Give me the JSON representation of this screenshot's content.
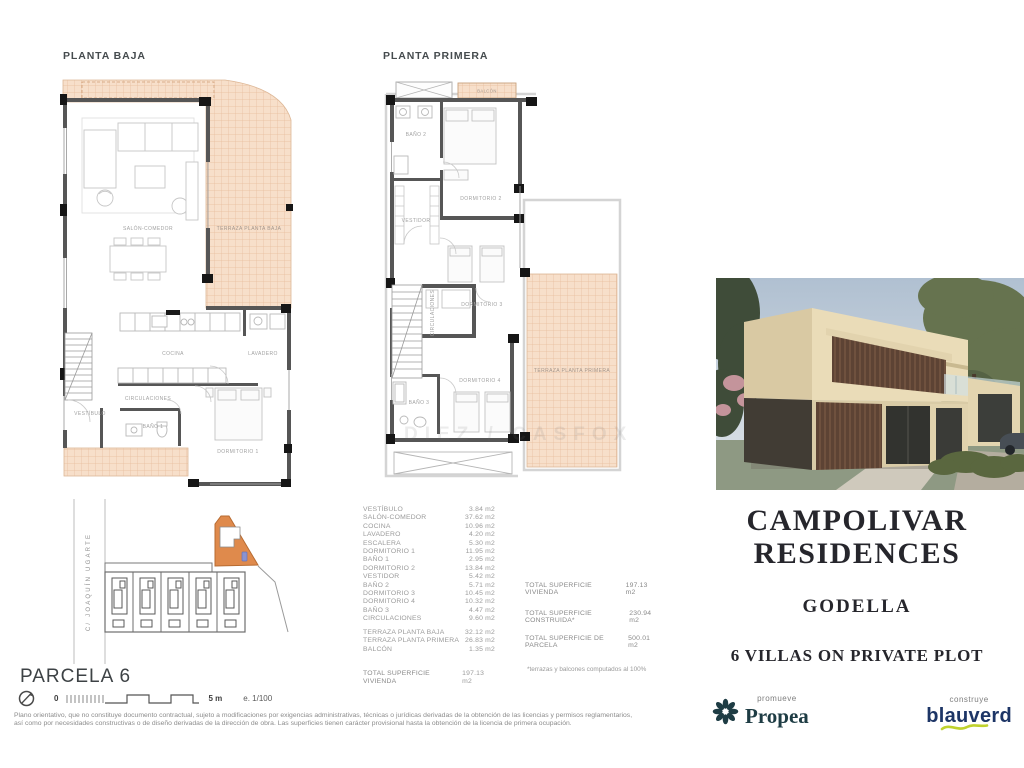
{
  "plans": {
    "planta_baja": {
      "title": "PLANTA BAJA",
      "rooms": {
        "salon": "SALÓN-COMEDOR",
        "terraza": "TERRAZA PLANTA BAJA",
        "cocina": "COCINA",
        "lavadero": "LAVADERO",
        "circulaciones": "CIRCULACIONES",
        "vestibulo": "VESTÍBULO",
        "bano1": "BAÑO 1",
        "dormitorio1": "DORMITORIO 1"
      }
    },
    "planta_primera": {
      "title": "PLANTA PRIMERA",
      "rooms": {
        "balcon": "BALCÓN",
        "bano2": "BAÑO 2",
        "dormitorio2": "DORMITORIO 2",
        "vestidor": "VESTIDOR",
        "circulaciones": "CIRCULACIONES",
        "dormitorio3": "DORMITORIO 3",
        "dormitorio4": "DORMITORIO 4",
        "bano3": "BAÑO 3",
        "terraza": "TERRAZA PLANTA PRIMERA"
      }
    }
  },
  "site_plan": {
    "street": "C/ JOAQUÍN UGARTE",
    "title": "PARCELA 6",
    "scale_zero": "0",
    "scale_label": "5 m",
    "scale_ratio": "e. 1/100"
  },
  "area_table": {
    "rows": [
      {
        "label": "VESTÍBULO",
        "value": "3.84 m2"
      },
      {
        "label": "SALÓN-COMEDOR",
        "value": "37.62 m2"
      },
      {
        "label": "COCINA",
        "value": "10.96 m2"
      },
      {
        "label": "LAVADERO",
        "value": "4.20 m2"
      },
      {
        "label": "ESCALERA",
        "value": "5.30 m2"
      },
      {
        "label": "DORMITORIO 1",
        "value": "11.95 m2"
      },
      {
        "label": "BAÑO 1",
        "value": "2.95 m2"
      },
      {
        "label": "DORMITORIO 2",
        "value": "13.84 m2"
      },
      {
        "label": "VESTIDOR",
        "value": "5.42 m2"
      },
      {
        "label": "BAÑO 2",
        "value": "5.71 m2"
      },
      {
        "label": "DORMITORIO 3",
        "value": "10.45 m2"
      },
      {
        "label": "DORMITORIO 4",
        "value": "10.32 m2"
      },
      {
        "label": "BAÑO 3",
        "value": "4.47 m2"
      },
      {
        "label": "CIRCULACIONES",
        "value": "9.60 m2"
      }
    ],
    "terrace_rows": [
      {
        "label": "TERRAZA PLANTA BAJA",
        "value": "32.12 m2"
      },
      {
        "label": "TERRAZA PLANTA PRIMERA",
        "value": "26.83 m2"
      },
      {
        "label": "BALCÓN",
        "value": "1.35 m2"
      }
    ],
    "total_row": {
      "label": "TOTAL SUPERFICIE VIVIENDA",
      "value": "197.13 m2"
    },
    "totals": [
      {
        "label": "TOTAL SUPERFICIE VIVIENDA",
        "value": "197.13 m2"
      },
      {
        "label": "TOTAL SUPERFICIE CONSTRUIDA*",
        "value": "230.94 m2"
      },
      {
        "label": "TOTAL SUPERFICIE DE PARCELA",
        "value": "500.01 m2"
      }
    ],
    "footnote": "*terrazas y balcones computados al 100%"
  },
  "project": {
    "name_line1": "CAMPOLIVAR",
    "name_line2": "RESIDENCES",
    "location": "GODELLA",
    "tagline": "6 VILLAS ON PRIVATE PLOT"
  },
  "logos": {
    "developer_role": "promueve",
    "developer_name": "Propea",
    "builder_role": "construye",
    "builder_name": "blauverd"
  },
  "watermark": "DIEZ / CASFOX",
  "disclaimer": {
    "line1": "Plano orientativo, que no constituye documento contractual, sujeto a modificaciones por exigencias administrativas, técnicas o jurídicas derivadas de la obtención de las licencias y permisos reglamentarios,",
    "line2": "así como por necesidades constructivas o de diseño derivadas de la dirección de obra. Las superficies tienen carácter provisional hasta la obtención de la licencia de primera ocupación."
  },
  "colors": {
    "terrace_fill": "#f7dfca",
    "terrace_grid": "#e7bc9b",
    "wall": "#565656",
    "parcel_highlight": "#df8a4c",
    "marker_blue": "#8b93cf",
    "propea_teal": "#1e3c44",
    "blauverd_blue": "#1d3566",
    "swoosh_green": "#c0d22e"
  }
}
